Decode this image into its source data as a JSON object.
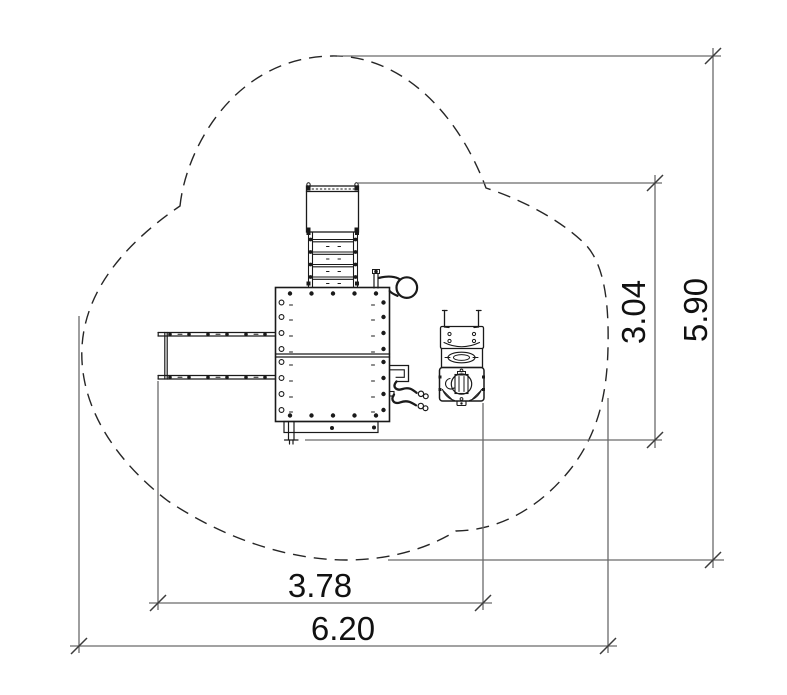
{
  "drawing": {
    "title": "playground-structure-plan-view",
    "units": "m",
    "colors": {
      "equipment": "#1a1a1a",
      "boundary": "#262626",
      "dimension_line": "#6a6a6b",
      "tick": "#3c3c3c",
      "text": "#111111",
      "background": "#ffffff"
    },
    "dimensions": {
      "equipment_width": {
        "label": "3.78",
        "orientation": "horizontal"
      },
      "overall_width": {
        "label": "6.20",
        "orientation": "horizontal"
      },
      "equipment_height": {
        "label": "3.04",
        "orientation": "vertical"
      },
      "overall_height": {
        "label": "5.90",
        "orientation": "vertical"
      }
    },
    "components": [
      {
        "name": "safety-zone-boundary",
        "style": "dashed-cloud"
      },
      {
        "name": "main-deck"
      },
      {
        "name": "access-ladder"
      },
      {
        "name": "top-platform"
      },
      {
        "name": "slide"
      },
      {
        "name": "loop-handle"
      },
      {
        "name": "hanging-cables"
      },
      {
        "name": "spring-rider"
      }
    ]
  }
}
